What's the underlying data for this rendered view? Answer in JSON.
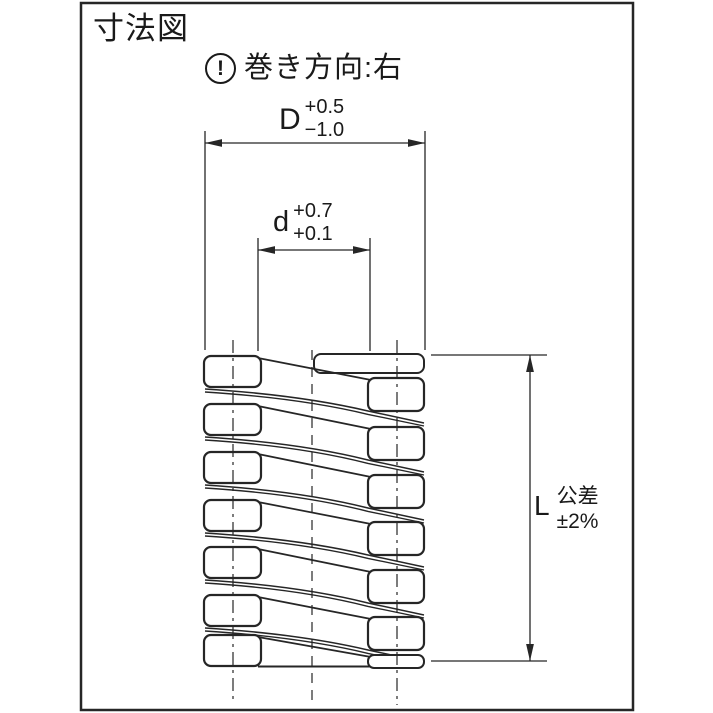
{
  "title": "寸法図",
  "note": {
    "icon_symbol": "!",
    "text": "巻き方向:右"
  },
  "dims": {
    "outer": {
      "label": "D",
      "upper": "+0.5",
      "lower": "−1.0"
    },
    "inner": {
      "label": "d",
      "upper": "+0.7",
      "lower": "+0.1"
    },
    "length": {
      "label": "L",
      "tol_title": "公差",
      "tol_value": "±2%"
    }
  },
  "colors": {
    "line": "#262626",
    "text": "#1a1a1a",
    "bg": "#ffffff"
  },
  "drawing": {
    "frame": {
      "x": 81,
      "y": 3,
      "w": 552,
      "h": 707
    },
    "leftCol": {
      "x": 204,
      "w": 57,
      "h": 31,
      "tops": [
        356,
        404,
        452,
        500,
        547,
        595,
        635
      ]
    },
    "rightCol": {
      "x": 368,
      "w": 56,
      "h": 33,
      "tops": [
        378,
        427,
        475,
        522,
        570,
        617
      ]
    },
    "tipTop": {
      "x": 314,
      "y": 354,
      "w": 110,
      "h": 19
    },
    "tipBottom": {
      "x": 368,
      "y": 655,
      "w": 56,
      "h": 13
    },
    "flatBottomY": 666.5,
    "centerLines": {
      "left": 233,
      "mid": 312,
      "right": 397,
      "top": 340,
      "bottom": 703
    },
    "dimD": {
      "y": 143,
      "x1": 205,
      "x2": 425,
      "extTop": 131,
      "extBottom": 350
    },
    "dimd": {
      "y": 250,
      "x1": 258,
      "x2": 370,
      "extTop": 238,
      "extBottom": 351
    },
    "dimL": {
      "x": 530,
      "y1": 355,
      "y2": 661,
      "extXFrom": 431,
      "extXTo": 547
    }
  }
}
